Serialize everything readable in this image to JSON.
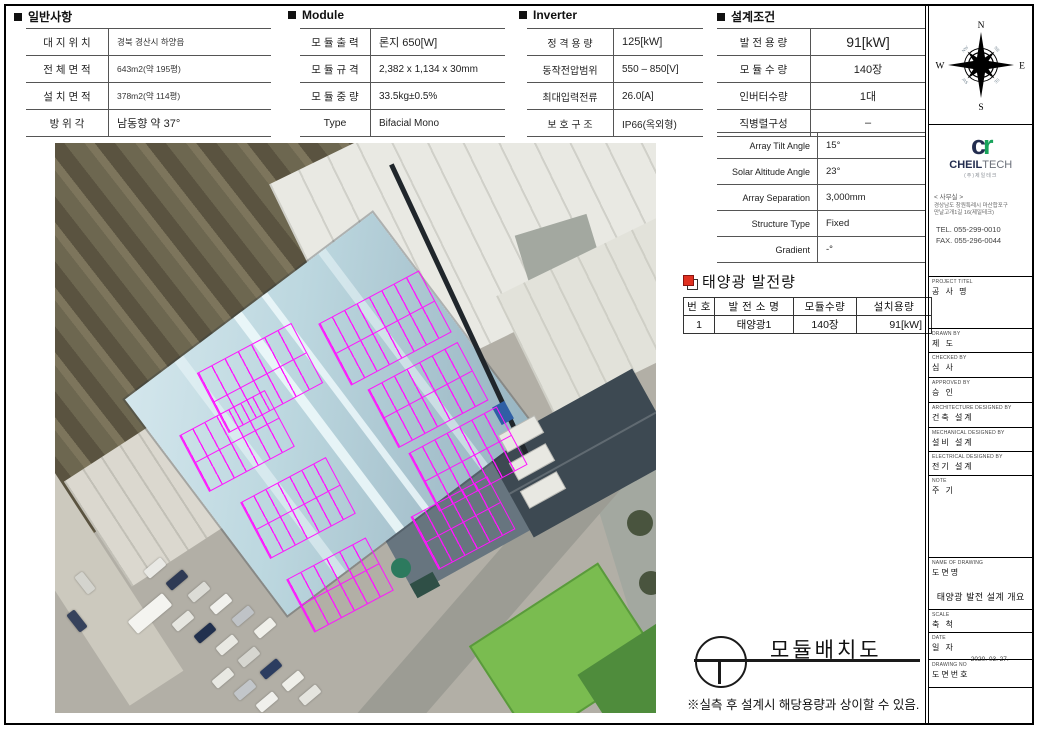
{
  "colors": {
    "magenta": "#ff14ff",
    "logo_navy": "#232d4f",
    "logo_green": "#18a35b",
    "icon_red": "#e03020"
  },
  "general": {
    "title": "일반사항",
    "rows": [
      {
        "label": "대 지 위 치",
        "value": "경북 경산시 하양읍"
      },
      {
        "label": "전 체 면 적",
        "value": "643m2(약 195평)"
      },
      {
        "label": "설 치 면 적",
        "value": "378m2(약 114평)"
      },
      {
        "label": "방  위  각",
        "value": "남동향 약 37°"
      }
    ]
  },
  "module": {
    "title": "Module",
    "rows": [
      {
        "label": "모 듈 출 력",
        "value": "론지 650[W]"
      },
      {
        "label": "모 듈 규 격",
        "value": "2,382 x 1,134 x 30mm"
      },
      {
        "label": "모 듈 중 량",
        "value": "33.5kg±0.5%"
      },
      {
        "label": "Type",
        "value": "Bifacial Mono"
      }
    ]
  },
  "inverter": {
    "title": "Inverter",
    "rows": [
      {
        "label": "정 격 용 량",
        "value": "125[kW]"
      },
      {
        "label": "동작전압범위",
        "value": "550 – 850[V]"
      },
      {
        "label": "최대입력전류",
        "value": "26.0[A]"
      },
      {
        "label": "보 호 구 조",
        "value": "IP66(옥외형)"
      }
    ]
  },
  "design": {
    "title": "설계조건",
    "rowsA": [
      {
        "label": "발 전 용 량",
        "value": "91[kW]"
      },
      {
        "label": "모 듈 수 량",
        "value": "140장"
      },
      {
        "label": "인버터수량",
        "value": "1대"
      },
      {
        "label": "직병렬구성",
        "value": "–"
      }
    ],
    "rowsB": [
      {
        "label": "Array Tilt Angle",
        "value": "15°"
      },
      {
        "label": "Solar Altitude Angle",
        "value": "23°"
      },
      {
        "label": "Array Separation",
        "value": "3,000mm"
      },
      {
        "label": "Structure Type",
        "value": "Fixed"
      },
      {
        "label": "Gradient",
        "value": "-°"
      }
    ]
  },
  "generation": {
    "title": "태양광 발전량",
    "headers": [
      "번 호",
      "발 전 소 명",
      "모듈수량",
      "설치용량"
    ],
    "col_widths": [
      30,
      78,
      62,
      74
    ],
    "rows": [
      [
        "1",
        "태양광1",
        "140장",
        "91[kW]"
      ]
    ]
  },
  "compass": {
    "n": "N",
    "s": "S",
    "e": "E",
    "w": "W",
    "ne": "NE",
    "se": "SE",
    "sw": "SW",
    "nw": "NW"
  },
  "company": {
    "logo_c": "c",
    "logo_r": "r",
    "name_bold": "CHEIL",
    "name_light": "TECH",
    "name_sub": "(주)제일테크",
    "office_label": "< 사무실 >",
    "address1": "경상남도 창원특례시 마산합포구",
    "address2": "만날고개1길 16(제일테크)",
    "tel": "TEL. 055-299-0010",
    "fax": "FAX. 055-296-0044"
  },
  "titleblock": {
    "sections": [
      {
        "en": "PROJECT TITEL",
        "ko": "공 사 명",
        "h": 52
      },
      {
        "en": "DRAWN BY",
        "ko": "제  도",
        "h": 24
      },
      {
        "en": "CHECKED BY",
        "ko": "심  사",
        "h": 25
      },
      {
        "en": "APPROVED BY",
        "ko": "승  인",
        "h": 25
      },
      {
        "en": "ARCHITECTURE DESIGNED BY",
        "ko": "건축 설계",
        "h": 25
      },
      {
        "en": "MECHANICAL DESIGNED BY",
        "ko": "설비 설계",
        "h": 24
      },
      {
        "en": "ELECTRICAL DESIGNED BY",
        "ko": "전기 설계",
        "h": 24
      },
      {
        "en": "NOTE",
        "ko": "주  기",
        "h": 82
      },
      {
        "en": "NAME OF DRAWING",
        "ko": "도면명",
        "h": 52,
        "value": "태양광 발전 설계 개요"
      },
      {
        "en": "SCALE",
        "ko": "축  척",
        "h": 23
      },
      {
        "en": "DATE",
        "ko": "일  자",
        "h": 27,
        "value": "2020. 03. 27."
      },
      {
        "en": "DRAWING NO",
        "ko": "도면번호",
        "h": 28
      },
      {
        "en": "",
        "ko": "",
        "h": 35
      }
    ]
  },
  "drawing": {
    "title": "모듈배치도",
    "note": "※실측 후 설계시 해당용량과 상이할 수 있음."
  },
  "photo": {
    "arrays": [
      {
        "x": 330,
        "y": 185,
        "w": 112,
        "h": 68,
        "cols": 8
      },
      {
        "x": 373,
        "y": 252,
        "w": 100,
        "h": 64,
        "cols": 7
      },
      {
        "x": 413,
        "y": 316,
        "w": 98,
        "h": 64,
        "cols": 7
      },
      {
        "x": 408,
        "y": 380,
        "w": 85,
        "h": 58,
        "cols": 6
      },
      {
        "x": 205,
        "y": 235,
        "w": 105,
        "h": 66,
        "cols": 7
      },
      {
        "x": 182,
        "y": 298,
        "w": 95,
        "h": 62,
        "cols": 7
      },
      {
        "x": 243,
        "y": 365,
        "w": 95,
        "h": 62,
        "cols": 7
      },
      {
        "x": 285,
        "y": 442,
        "w": 88,
        "h": 58,
        "cols": 6
      }
    ],
    "array_rotation": -28,
    "cars": [
      {
        "x": 100,
        "y": 425,
        "c": "#e9e9e5"
      },
      {
        "x": 122,
        "y": 437,
        "c": "#2e3a55"
      },
      {
        "x": 144,
        "y": 449,
        "c": "#dcdcd6"
      },
      {
        "x": 166,
        "y": 461,
        "c": "#f1f1ed"
      },
      {
        "x": 188,
        "y": 473,
        "c": "#bfc3c7"
      },
      {
        "x": 210,
        "y": 485,
        "c": "#f0f0ea"
      },
      {
        "x": 128,
        "y": 478,
        "c": "#e6e6e0"
      },
      {
        "x": 150,
        "y": 490,
        "c": "#21304e"
      },
      {
        "x": 172,
        "y": 502,
        "c": "#e9e9e3"
      },
      {
        "x": 194,
        "y": 514,
        "c": "#d6d6d0"
      },
      {
        "x": 216,
        "y": 526,
        "c": "#2c3d60"
      },
      {
        "x": 238,
        "y": 538,
        "c": "#efefe9"
      },
      {
        "x": 168,
        "y": 535,
        "c": "#e8e8e2"
      },
      {
        "x": 190,
        "y": 547,
        "c": "#c2c6ca"
      },
      {
        "x": 212,
        "y": 559,
        "c": "#f0f0ec"
      },
      {
        "x": 255,
        "y": 552,
        "c": "#e4e4de"
      },
      {
        "x": 30,
        "y": 440,
        "c": "#d4d4ce",
        "r": -38
      },
      {
        "x": 22,
        "y": 478,
        "c": "#36425c",
        "r": -38
      },
      {
        "x": 95,
        "y": 470,
        "c": "#f4f4f0",
        "w": 16,
        "h": 45
      }
    ]
  }
}
